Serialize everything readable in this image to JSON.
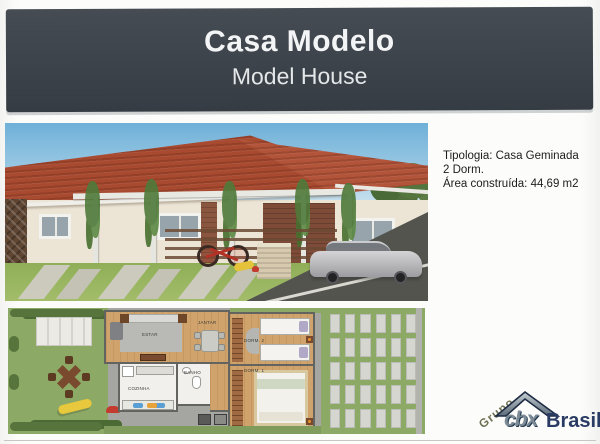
{
  "header": {
    "title": "Casa Modelo",
    "subtitle": "Model House"
  },
  "specs": {
    "tipologia": "Tipologia:  Casa Geminada",
    "dorms": "2 Dorm.",
    "area": "Área construída: 44,69 m2"
  },
  "floorplan": {
    "labels": {
      "estar": "ESTAR",
      "jantar": "JANTAR",
      "cozinha": "COZINHA",
      "banho": "BANHO",
      "dorm2": "DORM. 2",
      "dorm1": "DORM. 1"
    }
  },
  "logo": {
    "grupo": "Grupo",
    "brand": "cbx",
    "suffix": "Brasil"
  },
  "colors": {
    "header_bg": "#3f454c",
    "roof": "#a8492f",
    "lawn": "#8caa66",
    "path_gray": "#a5a5a1",
    "logo_navy": "#2a3c64"
  }
}
